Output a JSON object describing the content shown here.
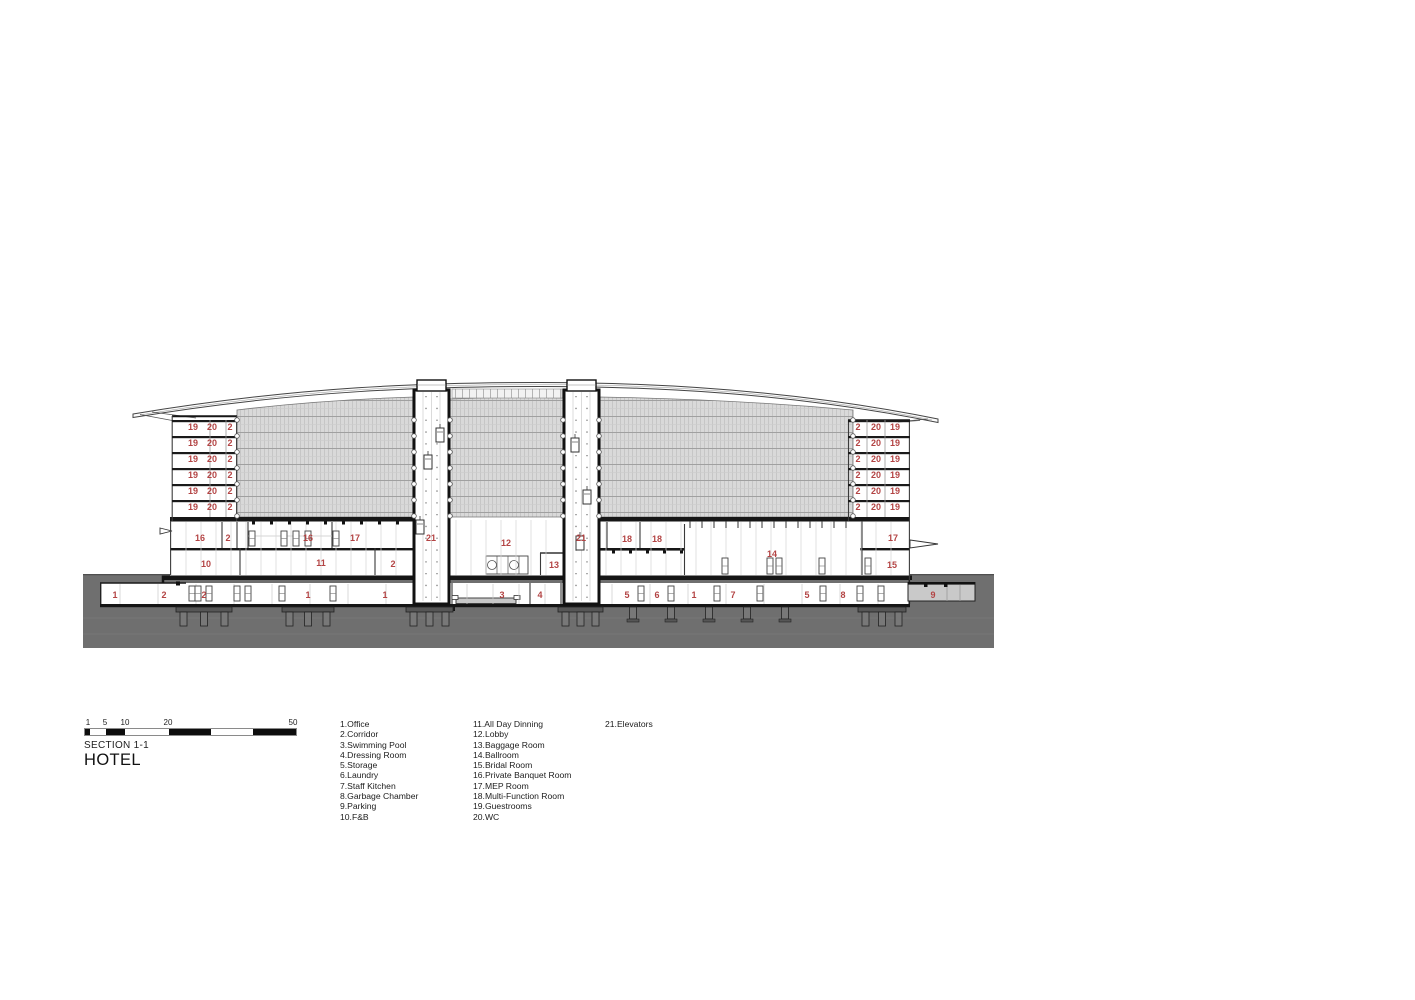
{
  "title_block": {
    "section": "SECTION 1-1",
    "name": "HOTEL"
  },
  "scale_bar": {
    "ticks": [
      "1",
      "5",
      "10",
      "20",
      "50"
    ]
  },
  "legend": {
    "col1": [
      "1.Office",
      "2.Corridor",
      "3.Swimming Pool",
      "4.Dressing Room",
      "5.Storage",
      "6.Laundry",
      "7.Staff Kitchen",
      "8.Garbage Chamber",
      "9.Parking",
      "10.F&B"
    ],
    "col2": [
      "11.All Day Dinning",
      "12.Lobby",
      "13.Baggage Room",
      "14.Ballroom",
      "15.Bridal Room",
      "16.Private Banquet Room",
      "17.MEP Room",
      "18.Multi-Function Room",
      "19.Guestrooms",
      "20.WC"
    ],
    "col3": [
      "21.Elevators"
    ]
  },
  "colors": {
    "label_red": "#b34444",
    "ground_gray": "#6f6f6f",
    "hatch_gray": "#d9d9d9",
    "parking_gray": "#c9c9c9"
  },
  "drawing": {
    "labels": [
      {
        "x": 193,
        "y": 430,
        "t": "19"
      },
      {
        "x": 212,
        "y": 430,
        "t": "20"
      },
      {
        "x": 230,
        "y": 430,
        "t": "2"
      },
      {
        "x": 193,
        "y": 446,
        "t": "19"
      },
      {
        "x": 212,
        "y": 446,
        "t": "20"
      },
      {
        "x": 230,
        "y": 446,
        "t": "2"
      },
      {
        "x": 193,
        "y": 462,
        "t": "19"
      },
      {
        "x": 212,
        "y": 462,
        "t": "20"
      },
      {
        "x": 230,
        "y": 462,
        "t": "2"
      },
      {
        "x": 193,
        "y": 478,
        "t": "19"
      },
      {
        "x": 212,
        "y": 478,
        "t": "20"
      },
      {
        "x": 230,
        "y": 478,
        "t": "2"
      },
      {
        "x": 193,
        "y": 494,
        "t": "19"
      },
      {
        "x": 212,
        "y": 494,
        "t": "20"
      },
      {
        "x": 230,
        "y": 494,
        "t": "2"
      },
      {
        "x": 193,
        "y": 510,
        "t": "19"
      },
      {
        "x": 212,
        "y": 510,
        "t": "20"
      },
      {
        "x": 230,
        "y": 510,
        "t": "2"
      },
      {
        "x": 858,
        "y": 430,
        "t": "2"
      },
      {
        "x": 876,
        "y": 430,
        "t": "20"
      },
      {
        "x": 895,
        "y": 430,
        "t": "19"
      },
      {
        "x": 858,
        "y": 446,
        "t": "2"
      },
      {
        "x": 876,
        "y": 446,
        "t": "20"
      },
      {
        "x": 895,
        "y": 446,
        "t": "19"
      },
      {
        "x": 858,
        "y": 462,
        "t": "2"
      },
      {
        "x": 876,
        "y": 462,
        "t": "20"
      },
      {
        "x": 895,
        "y": 462,
        "t": "19"
      },
      {
        "x": 858,
        "y": 478,
        "t": "2"
      },
      {
        "x": 876,
        "y": 478,
        "t": "20"
      },
      {
        "x": 895,
        "y": 478,
        "t": "19"
      },
      {
        "x": 858,
        "y": 494,
        "t": "2"
      },
      {
        "x": 876,
        "y": 494,
        "t": "20"
      },
      {
        "x": 895,
        "y": 494,
        "t": "19"
      },
      {
        "x": 858,
        "y": 510,
        "t": "2"
      },
      {
        "x": 876,
        "y": 510,
        "t": "20"
      },
      {
        "x": 895,
        "y": 510,
        "t": "19"
      },
      {
        "x": 200,
        "y": 541,
        "t": "16"
      },
      {
        "x": 228,
        "y": 541,
        "t": "2"
      },
      {
        "x": 308,
        "y": 541,
        "t": "16"
      },
      {
        "x": 355,
        "y": 541,
        "t": "17"
      },
      {
        "x": 431,
        "y": 541,
        "t": "21"
      },
      {
        "x": 581,
        "y": 541,
        "t": "21"
      },
      {
        "x": 506,
        "y": 546,
        "t": "12"
      },
      {
        "x": 554,
        "y": 568,
        "t": "13"
      },
      {
        "x": 627,
        "y": 542,
        "t": "18"
      },
      {
        "x": 657,
        "y": 542,
        "t": "18"
      },
      {
        "x": 772,
        "y": 557,
        "t": "14"
      },
      {
        "x": 893,
        "y": 541,
        "t": "17"
      },
      {
        "x": 892,
        "y": 568,
        "t": "15"
      },
      {
        "x": 206,
        "y": 567,
        "t": "10"
      },
      {
        "x": 321,
        "y": 566,
        "t": "11"
      },
      {
        "x": 393,
        "y": 567,
        "t": "2"
      },
      {
        "x": 115,
        "y": 598,
        "t": "1"
      },
      {
        "x": 164,
        "y": 598,
        "t": "2"
      },
      {
        "x": 204,
        "y": 598,
        "t": "2"
      },
      {
        "x": 308,
        "y": 598,
        "t": "1"
      },
      {
        "x": 385,
        "y": 598,
        "t": "1"
      },
      {
        "x": 502,
        "y": 598,
        "t": "3"
      },
      {
        "x": 540,
        "y": 598,
        "t": "4"
      },
      {
        "x": 627,
        "y": 598,
        "t": "5"
      },
      {
        "x": 657,
        "y": 598,
        "t": "6"
      },
      {
        "x": 694,
        "y": 598,
        "t": "1"
      },
      {
        "x": 733,
        "y": 598,
        "t": "7"
      },
      {
        "x": 807,
        "y": 598,
        "t": "5"
      },
      {
        "x": 843,
        "y": 598,
        "t": "8"
      },
      {
        "x": 933,
        "y": 598,
        "t": "9"
      }
    ]
  }
}
